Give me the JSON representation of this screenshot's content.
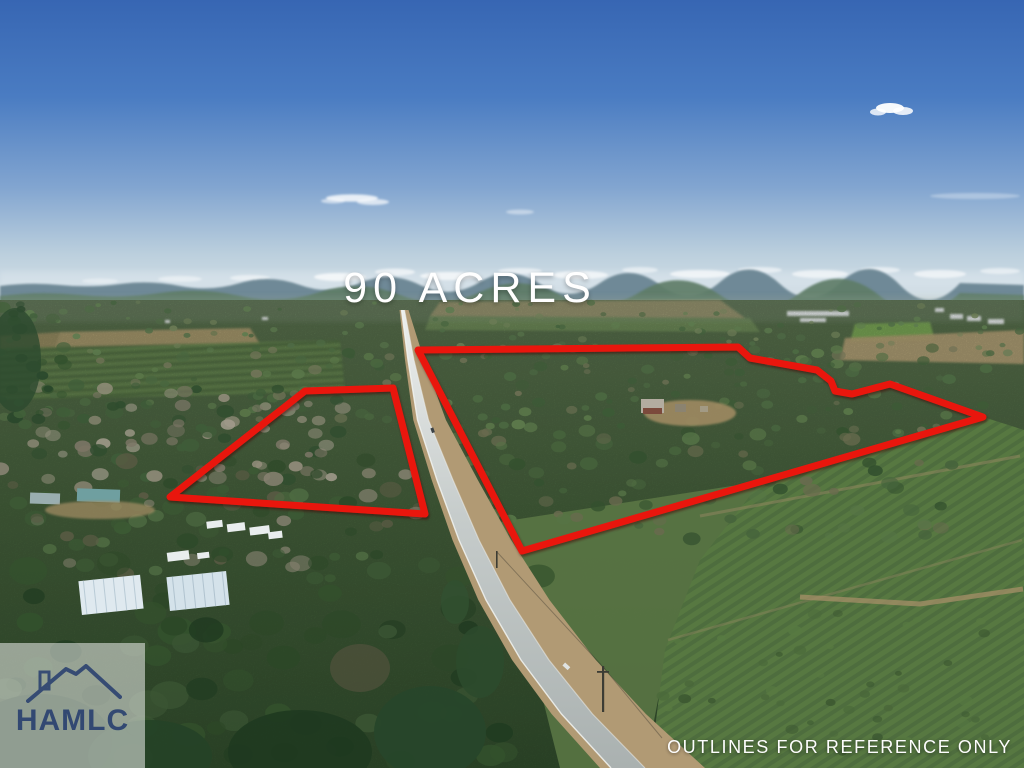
{
  "overlay": {
    "acreage_label": "90 ACRES",
    "disclaimer": "OUTLINES FOR REFERENCE ONLY"
  },
  "watermark": {
    "brand": "HAMLC",
    "icon": "house-roof-icon"
  },
  "outlines": {
    "stroke_color": "#e9190f",
    "stroke_width": 7,
    "parcels": [
      {
        "name": "west-parcel",
        "points": "305,391 393,388 425,514 170,497"
      },
      {
        "name": "east-parcel",
        "points": "418,350 738,347 750,358 817,370 831,381 835,391 852,394 890,384 983,417 522,551"
      }
    ]
  },
  "palette": {
    "sky_top": "#3766b3",
    "sky_horizon": "#d9e3e9",
    "outline_red": "#e9190f",
    "logo_navy": "#263d6e",
    "text_white": "#ffffff"
  }
}
